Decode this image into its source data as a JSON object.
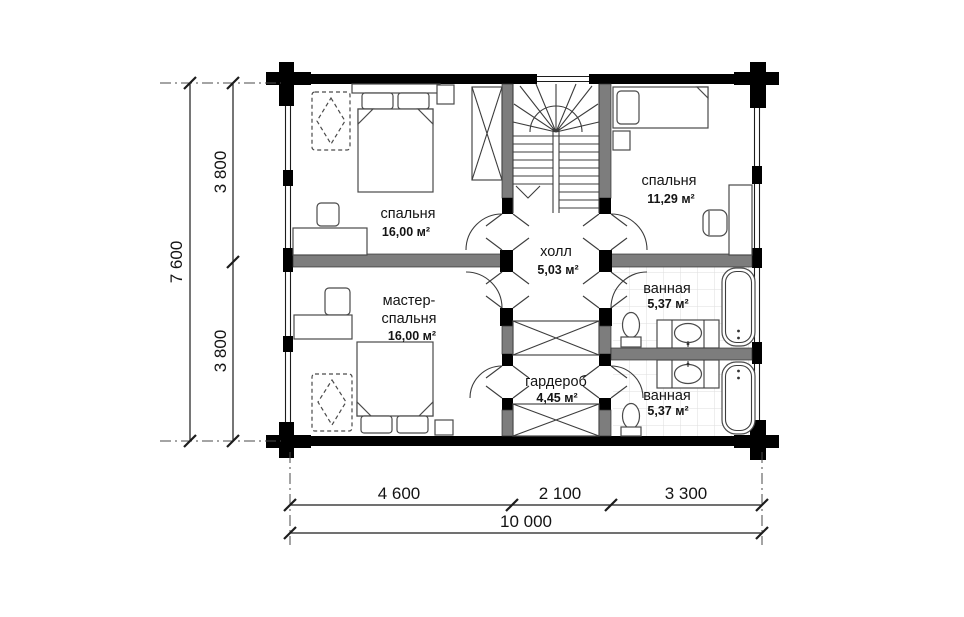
{
  "rooms": [
    {
      "id": "bedroom-top-left",
      "name": "спальня",
      "area": "16,00 м²"
    },
    {
      "id": "bedroom-top-right",
      "name": "спальня",
      "area": "11,29 м²"
    },
    {
      "id": "hall",
      "name": "холл",
      "area": "5,03 м²"
    },
    {
      "id": "master-bedroom",
      "name_line1": "мастер-",
      "name_line2": "спальня",
      "area": "16,00 м²"
    },
    {
      "id": "bathroom-upper",
      "name": "ванная",
      "area": "5,37 м²"
    },
    {
      "id": "bathroom-lower",
      "name": "ванная",
      "area": "5,37 м²"
    },
    {
      "id": "wardrobe",
      "name": "гардероб",
      "area": "4,45 м²"
    }
  ],
  "dimensions": {
    "vertical_total": "7 600",
    "vertical_segment_top": "3 800",
    "vertical_segment_bottom": "3 800",
    "horizontal_segment_left": "4 600",
    "horizontal_segment_middle": "2 100",
    "horizontal_segment_right": "3 300",
    "horizontal_total": "10 000"
  },
  "icons": [
    "double-bed-icon",
    "single-bed-icon",
    "armchair-icon",
    "wardrobe-x-icon",
    "stairs-icon",
    "toilet-icon",
    "bathtub-icon",
    "sink-vanity-icon",
    "desk-icon",
    "stool-icon",
    "nightstand-icon",
    "chair-icon"
  ],
  "colors": {
    "wall": "#000000",
    "partition": "#7d7d7d",
    "background": "#ffffff",
    "tile_grid": "#dedede",
    "text": "#141414"
  }
}
